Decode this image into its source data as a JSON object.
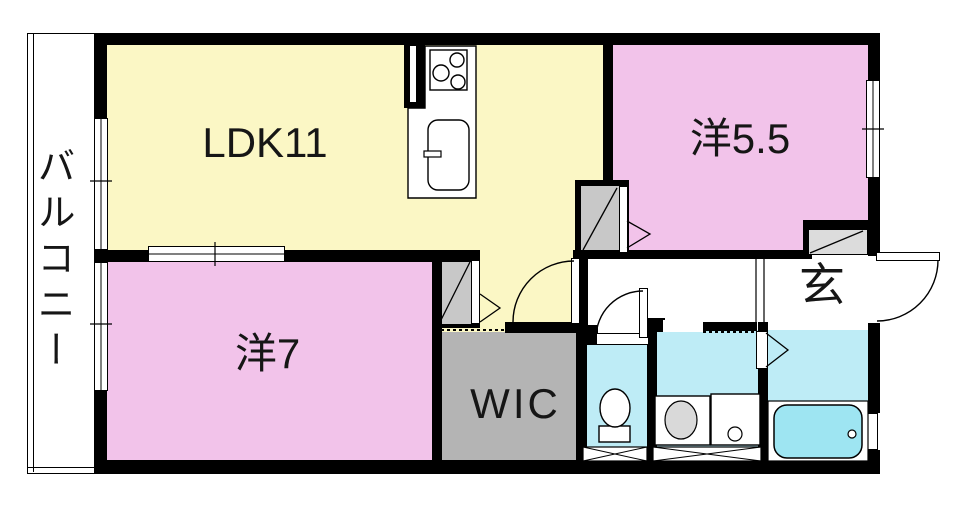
{
  "plan_title": "1LDK+2 apartment floor plan",
  "balcony": {
    "label": "バルコニー"
  },
  "rooms": {
    "ldk": {
      "label": "LDK11"
    },
    "bedroom_55": {
      "label": "洋5.5"
    },
    "bedroom_7": {
      "label": "洋7"
    },
    "wic": {
      "label": "WIC"
    },
    "entrance": {
      "label": "玄"
    }
  },
  "colors": {
    "ldk_floor": "#FBF7C5",
    "bedroom_floor": "#F2C3EA",
    "wic_floor": "#B4B4B4",
    "closet_fill": "#C8C8C8",
    "shoe_closet_fill": "#DCDCDC",
    "wet_area_floor": "#BEECF6",
    "bathtub_fill": "#9EE5F2",
    "wall": "#000000",
    "label_text": "#161616"
  }
}
